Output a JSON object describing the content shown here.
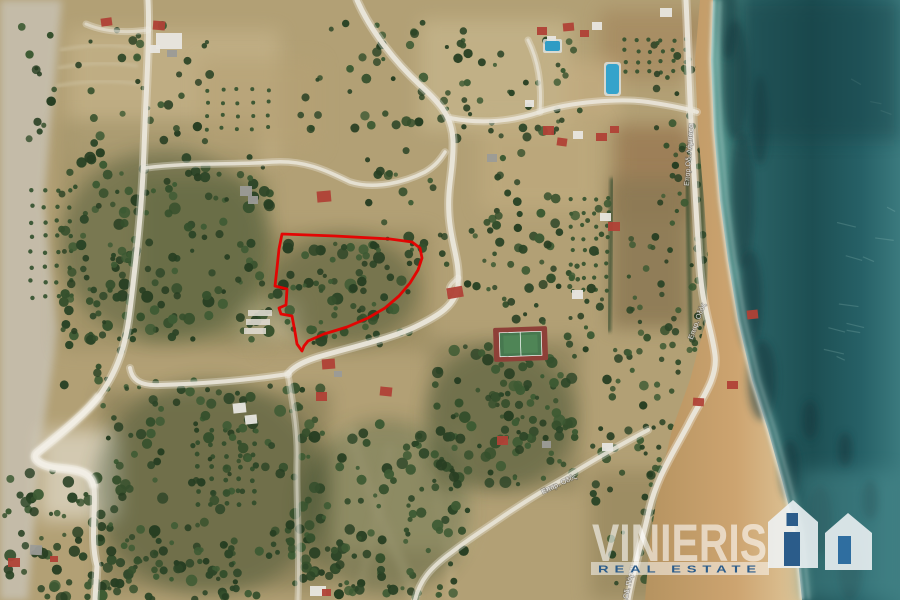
{
  "image_type": "aerial-satellite-property-listing-photo",
  "palette": {
    "outline_red": "#e60000",
    "logo_blue": "#2b5c8a",
    "sea_deep": "#1d4f53",
    "sea_shallow": "#79b0a4",
    "sand": "#c79d69",
    "terrain_tan": "#b2a075"
  },
  "watermark": {
    "brand": "VINIERIS",
    "subtitle": "REAL ESTATE",
    "logo_icon": "twin-gabled-houses-icon"
  },
  "property_outline": {
    "name": "property-boundary",
    "color": "#e60000",
    "points": [
      [
        282,
        234
      ],
      [
        335,
        236
      ],
      [
        390,
        239
      ],
      [
        412,
        242
      ],
      [
        420,
        248
      ],
      [
        422,
        258
      ],
      [
        418,
        270
      ],
      [
        410,
        283
      ],
      [
        399,
        296
      ],
      [
        385,
        308
      ],
      [
        368,
        318
      ],
      [
        347,
        327
      ],
      [
        324,
        334
      ],
      [
        308,
        341
      ],
      [
        304,
        346
      ],
      [
        302,
        351
      ],
      [
        297,
        344
      ],
      [
        295,
        332
      ],
      [
        292,
        316
      ],
      [
        281,
        314
      ],
      [
        279,
        308
      ],
      [
        286,
        305
      ],
      [
        287,
        289
      ],
      [
        275,
        286
      ],
      [
        277,
        268
      ],
      [
        279,
        249
      ]
    ]
  },
  "road_labels": [
    {
      "text": "Επαρ.Οδ. Λάμπασα",
      "x": 691,
      "y": 155,
      "rot": -86
    },
    {
      "text": "Επαρ. Οδός",
      "x": 699,
      "y": 322,
      "rot": -70
    },
    {
      "text": "Επαρ.Οδ. Πόρου",
      "x": 629,
      "y": 592,
      "rot": -78
    },
    {
      "text": "Επαρ. Οδός",
      "x": 560,
      "y": 486,
      "rot": -25
    }
  ],
  "map_features": [
    "sea",
    "beach",
    "coastal-road",
    "tennis-court",
    "swimming-pools",
    "olive-groves",
    "scrub",
    "houses",
    "red-roofed-villas",
    "cliffs",
    "hairpin-road"
  ]
}
